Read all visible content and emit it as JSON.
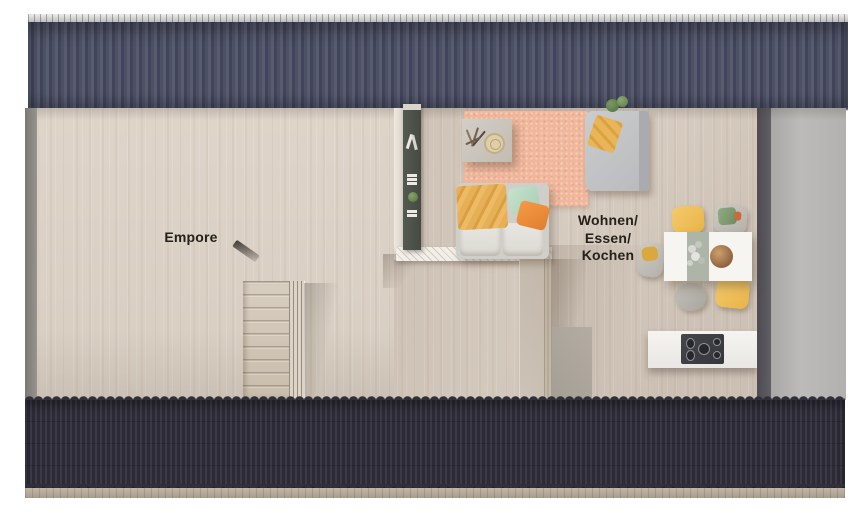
{
  "plan": {
    "kind": "attic-floor-plan-rendering",
    "labels": {
      "room_left": "Empore",
      "room_right_line1": "Wohnen/",
      "room_right_line2": "Essen/",
      "room_right_line3": "Kochen"
    },
    "rooms": [
      {
        "id": "empore",
        "label": "Empore"
      },
      {
        "id": "wohnen-essen-kochen",
        "label": "Wohnen/Essen/Kochen"
      }
    ],
    "furniture": [
      "stairs",
      "bookshelf",
      "sofa",
      "coffee-table",
      "rug",
      "daybed",
      "dining-table",
      "dining-chairs",
      "kitchen-island",
      "cooktop"
    ],
    "colors": {
      "background": "#ffffff",
      "roof_top": "#4a4d60",
      "roof_bottom": "#32313c",
      "ridge": "#cfcfcf",
      "eave": "#b3a795",
      "floor": "#dcd2c7",
      "wall_left": "#8a8783",
      "wall_right_dark": "#565459",
      "gable_band": "#b5b4b2",
      "rug": "#f1b79c",
      "sofa": "#cfcec9",
      "throw_yellow": "#e6b058",
      "pillow_mint": "#bcdcc5",
      "pillow_orange": "#ee8e3d",
      "table_runner": "#adb5a9",
      "chair_yellow": "#f2c45f",
      "cooktop": "#3d3f44",
      "shelf": "#4c5049",
      "label_text": "#26211b"
    }
  }
}
